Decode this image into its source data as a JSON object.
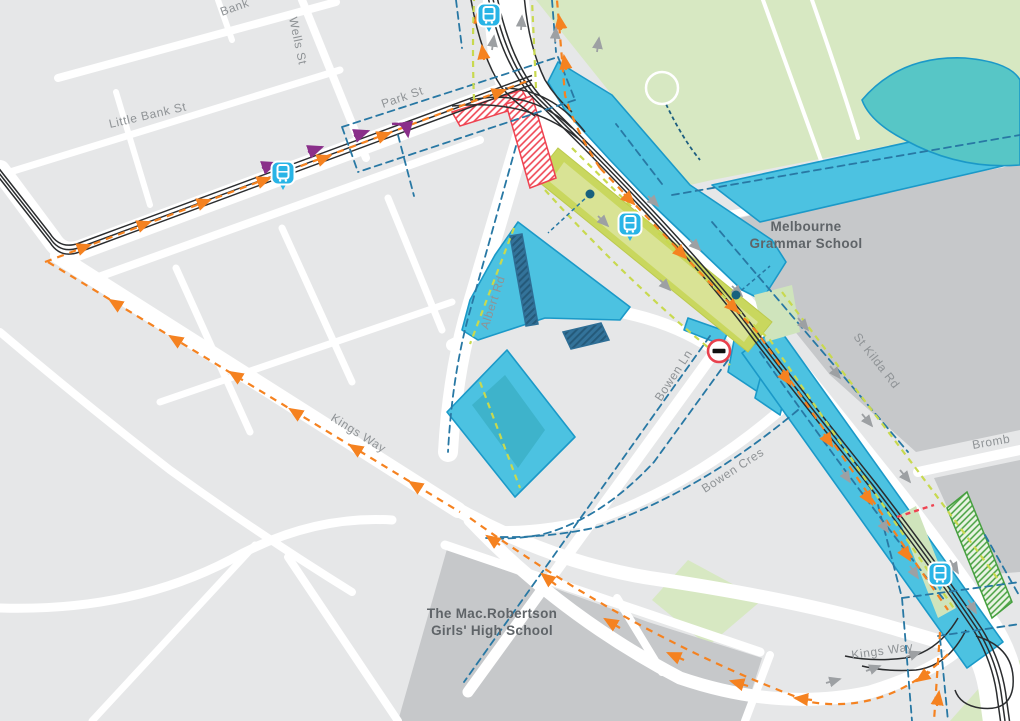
{
  "map": {
    "description": "Street map of construction works around St Kilda Rd / Kings Way / Albert Rd, Melbourne",
    "streets": {
      "bank": "Bank",
      "wells": "Wells St",
      "little_bank": "Little Bank St",
      "park": "Park St",
      "albert": "Albert Rd",
      "st_kilda": "St Kilda Rd",
      "bromby": "Bromb",
      "bowen_ln": "Bowen Ln",
      "bowen_cres": "Bowen Cres",
      "kings_way_west": "Kings Way",
      "kings_way_south": "Kings Way"
    },
    "places": {
      "grammar_line1": "Melbourne",
      "grammar_line2": "Grammar School",
      "macrob_line1": "The Mac.Robertson",
      "macrob_line2": "Girls' High School"
    },
    "icons": {
      "tram_stop_count": "4",
      "no_entry_count": "1"
    },
    "colors": {
      "road": "#ffffff",
      "block": "#e6e7e8",
      "school_grounds": "#c6c8ca",
      "park": "#d7e8c2",
      "construction_zone": "#4cc2e1",
      "construction_zone_border": "#1b99c8",
      "park_works_zone": "#57c6c6",
      "station_median": "#c9d75e",
      "station_median_inner": "#d9e395",
      "structure_blue": "#2e6e95",
      "tram_track": "#2b2d2f",
      "route_orange": "#f58220",
      "boundary_blue": "#2878a4",
      "lane_lime": "#c8d94f",
      "closure_red": "#ef4351",
      "tram_stop_blue": "#28b4e6",
      "arrow_gray": "#9da0a3",
      "route_purple": "#8a2f8a",
      "hatch_green": "#46a03f"
    }
  }
}
